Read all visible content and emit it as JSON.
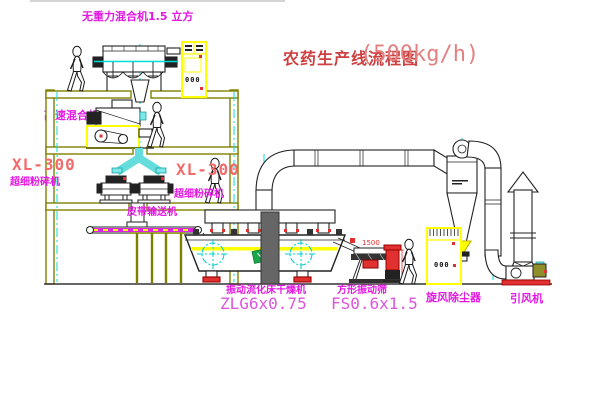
{
  "diagram": {
    "title": "农药生产线流程图",
    "capacity": "(500kg/h)"
  },
  "labels": {
    "gravity_mixer": "无重力混合机1.5 立方",
    "high_speed_mixer": "高速混合机3立方",
    "pulverizer_left_model": "XL-300",
    "pulverizer_left_name": "超细粉碎机",
    "pulverizer_right_model": "XL-300",
    "pulverizer_right_name": "超细粉碎机",
    "belt_conveyor": "皮带输送机",
    "dryer_name": "振动流化床干燥机",
    "dryer_model": "ZLG6x0.75",
    "screen_name": "方形振动筛",
    "screen_model": "FS0.6x1.5",
    "cyclone": "旋风除尘器",
    "induced_fan": "引风机",
    "dimension_1500": "1500",
    "cabinet_marks": "000"
  },
  "colors": {
    "structure_olive": "#7F7F00",
    "centerline_cyan": "#00DDDD",
    "label_magenta": "#E318E3",
    "title_red": "#CC4040",
    "model_red": "#F26B6B",
    "equipment_yellow": "#FFFF00",
    "accent_red": "#E03030",
    "logo_green": "#18A84C"
  }
}
